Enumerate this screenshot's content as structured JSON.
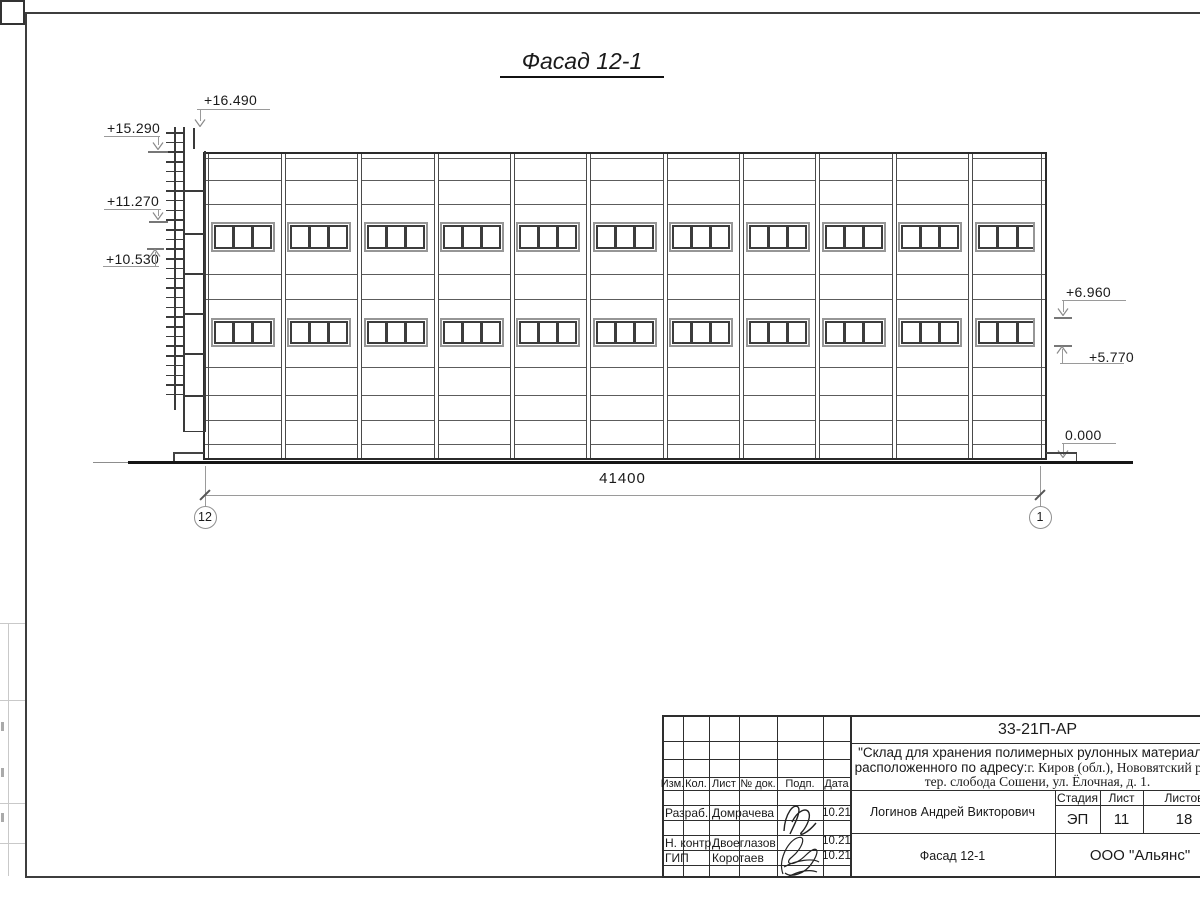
{
  "drawing": {
    "title": "Фасад 12-1",
    "dimension_total": "41400",
    "axis_left": "12",
    "axis_right": "1",
    "elevation_marks": [
      {
        "label": "+16.490"
      },
      {
        "label": "+15.290"
      },
      {
        "label": "+11.270"
      },
      {
        "label": "+10.530"
      },
      {
        "label": "+6.960"
      },
      {
        "label": "+5.770"
      },
      {
        "label": "0.000"
      }
    ],
    "facade": {
      "bays": 11,
      "window_rows": 2,
      "panes_per_window": 3,
      "ladder_rungs": 28
    }
  },
  "title_block": {
    "doc_number": "33-21П-АР",
    "project_line1": "\"Склад для хранения полимерных рулонных материалов",
    "project_line2_sans": "расположенного по адресу: ",
    "project_line2_serif": "г. Киров (обл.), Нововятский р-он",
    "project_line3": "тер. слобода Сошени, ул. Ёлочная, д. 1.",
    "columns": [
      "Изм.",
      "Кол.",
      "Лист",
      "№ док.",
      "Подп.",
      "Дата"
    ],
    "stage_label": "Стадия",
    "sheet_label": "Лист",
    "sheets_label": "Листов",
    "stage": "ЭП",
    "sheet": "11",
    "sheets": "18",
    "people": [
      {
        "role": "Разраб.",
        "name": "Домрачева",
        "date": "10.21"
      },
      {
        "role": "Н. контр.",
        "name": "Двоеглазов",
        "date": "10.21"
      },
      {
        "role": "ГИП",
        "name": "Коротаев",
        "date": "10.21"
      }
    ],
    "approver": "Логинов Андрей Викторович",
    "drawing_name": "Фасад 12-1",
    "company": "ООО \"Альянс\""
  },
  "colors": {
    "line_dark": "#2e2e2e",
    "line_light": "#9a9a9a",
    "text": "#1a1a1a"
  }
}
